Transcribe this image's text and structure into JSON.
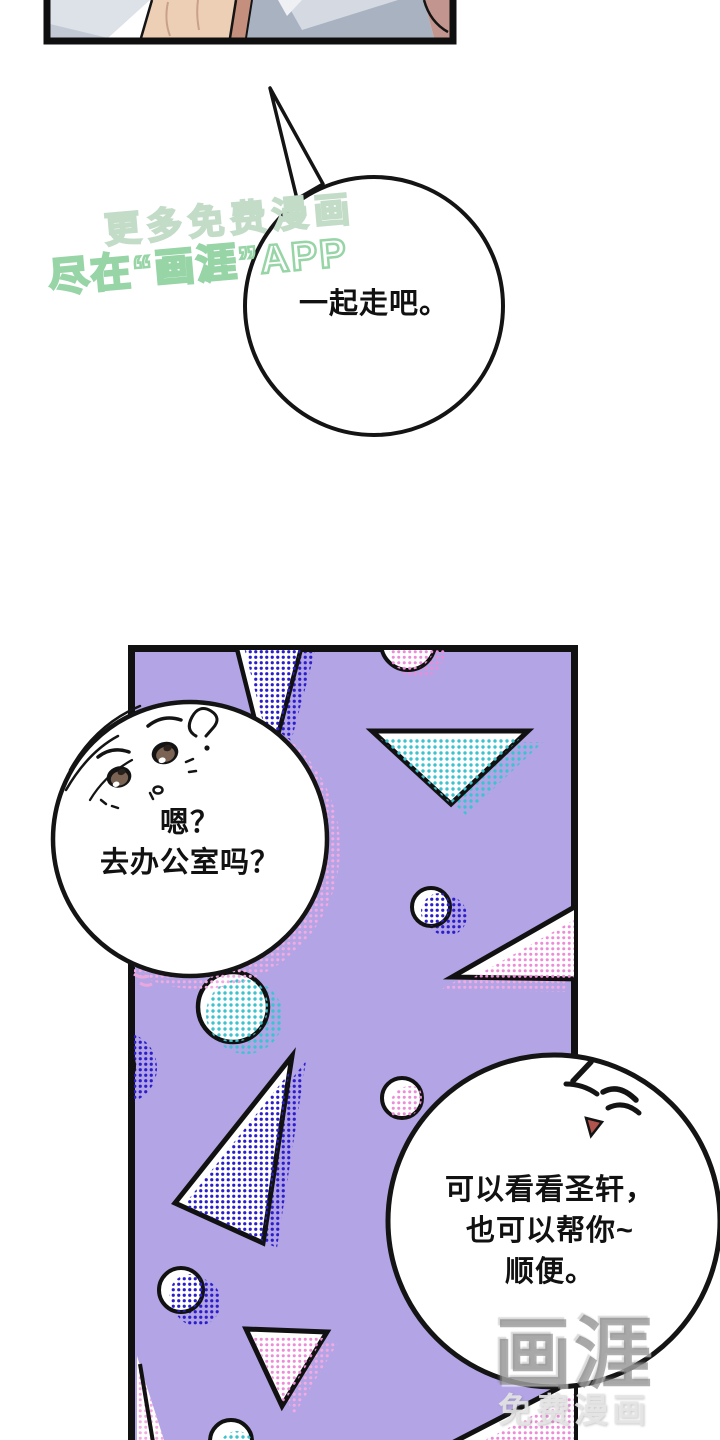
{
  "page": {
    "kind": "webtoon-comic-page",
    "background": "#ffffff"
  },
  "speech_bubbles": {
    "top": {
      "text": "一起走吧。"
    },
    "left": {
      "line1": "嗯？",
      "line2": "去办公室吗？"
    },
    "right": {
      "line1": "可以看看圣轩，",
      "line2": "也可以帮你~",
      "line3": "顺便。"
    }
  },
  "watermarks": {
    "promo": {
      "line1": "更多免费漫画",
      "line2": "尽在“画涯”APP"
    },
    "logo": {
      "name": "画涯",
      "caption": "免费漫画"
    }
  },
  "icons": {
    "left_bubble_face": "curious-face-icon",
    "right_bubble_face": "pleased-wink-face-icon",
    "question_curl": "question-curl-icon"
  },
  "colors": {
    "panel_purple": "#b3a4e5",
    "halftone_blue": "#2a1ecb",
    "halftone_cyan": "#3bc3cf",
    "halftone_pink": "#ec8cd8",
    "halftone_pink_light": "#f3aae2",
    "outline_black": "#141414",
    "watermark_green": "#97d4a6",
    "watermark_gray": "#8a8a8a",
    "skin_tone": "#eccfb5",
    "fabric_gray": "#a9b2c1"
  }
}
